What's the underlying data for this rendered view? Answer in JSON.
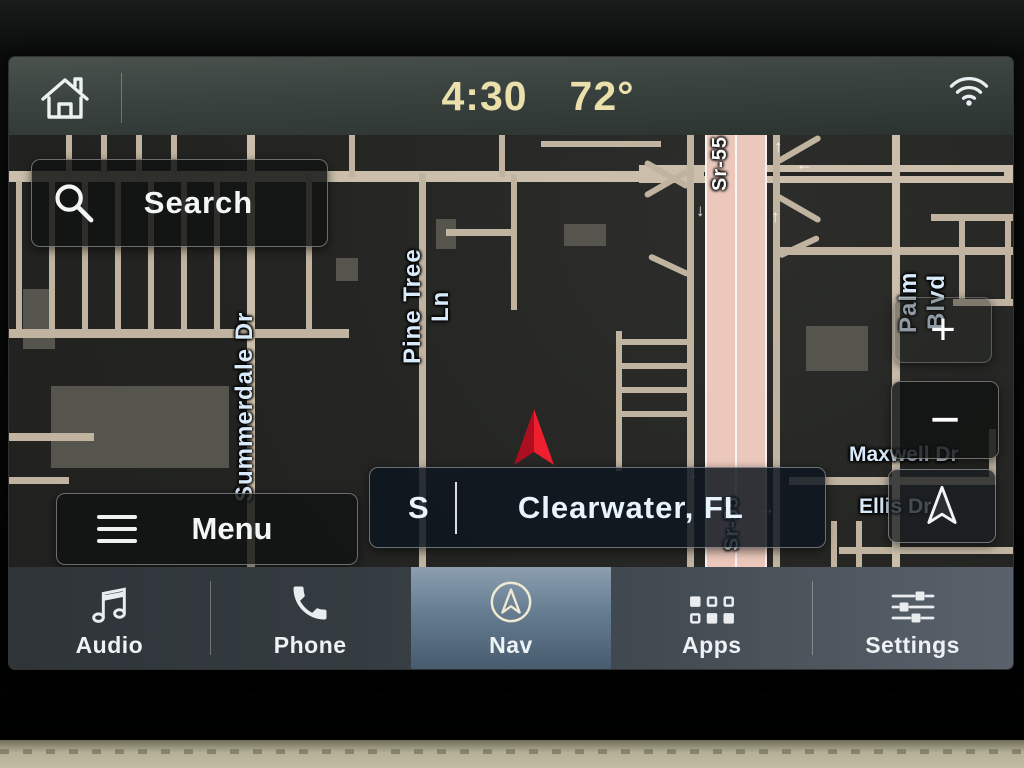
{
  "status_bar": {
    "time": "4:30",
    "temperature": "72°"
  },
  "map": {
    "search_label": "Search",
    "menu_label": "Menu",
    "location_bar": {
      "direction": "S",
      "location": "Clearwater, FL"
    },
    "zoom_in_label": "+",
    "zoom_out_label": "−",
    "streets": [
      {
        "name": "Summerdale Dr"
      },
      {
        "name": "Pine Tree Ln"
      },
      {
        "name": "Sr-55"
      },
      {
        "name": "Sr-55"
      },
      {
        "name": "Palm Blvd"
      },
      {
        "name": "Maxwell Dr"
      },
      {
        "name": "Ellis Dr"
      }
    ],
    "lane_arrows": [
      {
        "glyph": "↑"
      },
      {
        "glyph": "←"
      },
      {
        "glyph": "↑"
      },
      {
        "glyph": "↓"
      },
      {
        "glyph": "↓"
      },
      {
        "glyph": "→"
      }
    ],
    "colors": {
      "road": "#c0b3a0",
      "highway": "#ecc8bc",
      "map_background": "#242522",
      "street_label": "#d9eafb",
      "position_arrow": "#ee1f30",
      "clock": "#ebdfac"
    }
  },
  "tab_bar": {
    "tabs": [
      {
        "label": "Audio",
        "icon": "music-note-icon",
        "active": false
      },
      {
        "label": "Phone",
        "icon": "phone-icon",
        "active": false
      },
      {
        "label": "Nav",
        "icon": "nav-compass-icon",
        "active": true
      },
      {
        "label": "Apps",
        "icon": "apps-grid-icon",
        "active": false
      },
      {
        "label": "Settings",
        "icon": "settings-sliders-icon",
        "active": false
      }
    ]
  }
}
